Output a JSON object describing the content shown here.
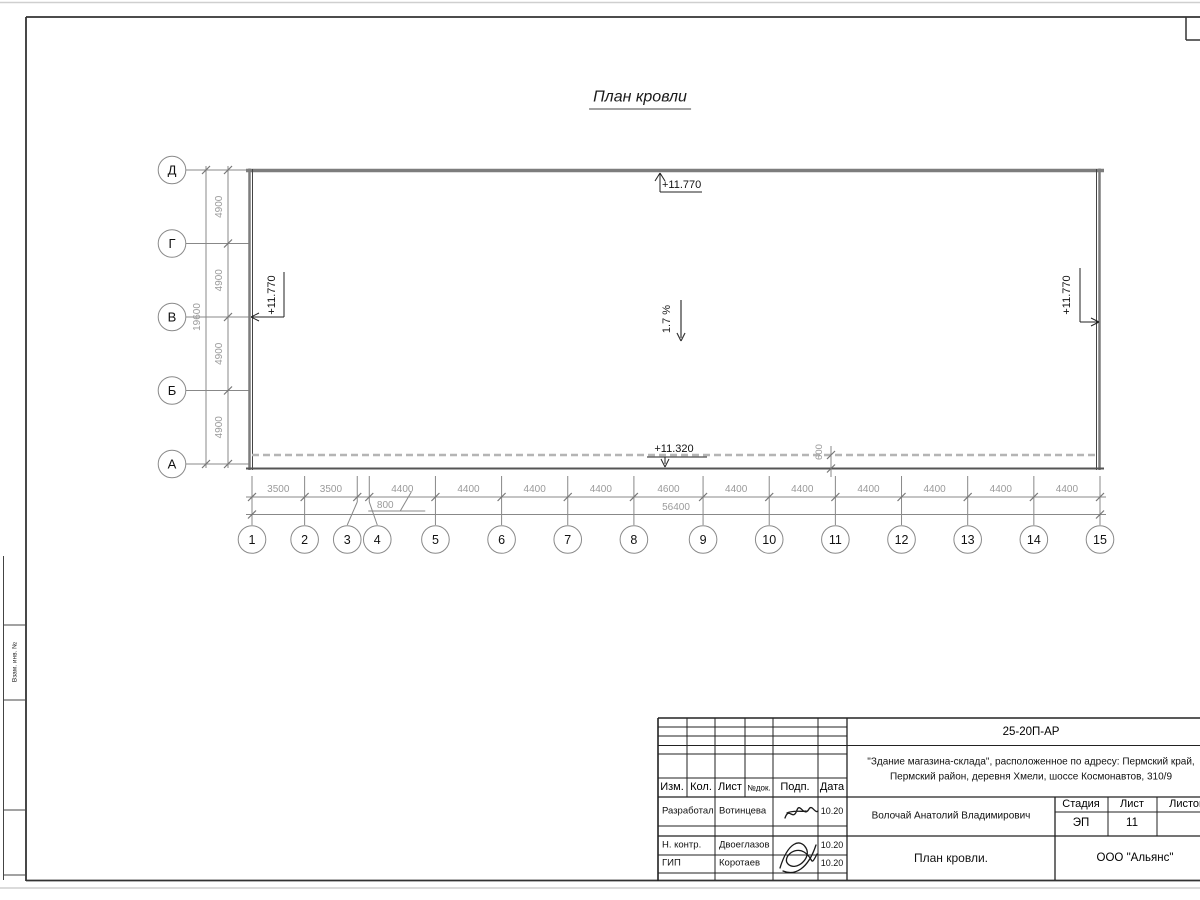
{
  "sheet": {
    "title": "План кровли"
  },
  "plan": {
    "row_axes": [
      "Д",
      "Г",
      "В",
      "Б",
      "А"
    ],
    "row_dims": [
      4900,
      4900,
      4900,
      4900
    ],
    "row_total": "19600",
    "col_axes": [
      "1",
      "2",
      "3",
      "4",
      "5",
      "6",
      "7",
      "8",
      "9",
      "10",
      "11",
      "12",
      "13",
      "14",
      "15"
    ],
    "col_dims": [
      3500,
      3500,
      800,
      4400,
      4400,
      4400,
      4400,
      4600,
      4400,
      4400,
      4400,
      4400,
      4400,
      4400
    ],
    "col_total": "56400",
    "elevations": {
      "top": "+11.770",
      "left": "+11.770",
      "right": "+11.770",
      "bottom": "+11.320"
    },
    "slope_label": "1.7 %",
    "eaves_offset": "600"
  },
  "left_strip": {
    "labels": [
      "Взам. инв. №",
      "",
      ""
    ]
  },
  "titleblock": {
    "doc_code": "25-20П-АР",
    "project_lines": [
      "\"Здание магазина-склада\", расположенное по адресу: Пермский край,",
      "Пермский район, деревня Хмели, шоссе Космонавтов, 310/9"
    ],
    "rev_header": [
      "Изм.",
      "Кол.",
      "Лист",
      "№док.",
      "Подп.",
      "Дата"
    ],
    "rows": [
      {
        "role": "Разработал",
        "name": "Вотинцева",
        "date": "10.20"
      },
      {
        "role": "Н. контр.",
        "name": "Двоеглазов",
        "date": "10.20"
      },
      {
        "role": "ГИП",
        "name": "Коротаев",
        "date": "10.20"
      }
    ],
    "chief": "Волочай Анатолий Владимирович",
    "stage_header": [
      "Стадия",
      "Лист",
      "Листов"
    ],
    "stage": "ЭП",
    "sheet_no": "11",
    "sheets_total": "",
    "drawing_title": "План кровли.",
    "company": "ООО \"Альянс\""
  },
  "colors": {
    "wall": "#7d7d7d",
    "line": "#444444",
    "dim_text": "#9a9a9a",
    "dim_line": "#888888",
    "dash": "#b5b5b5",
    "dark": "#222222"
  }
}
